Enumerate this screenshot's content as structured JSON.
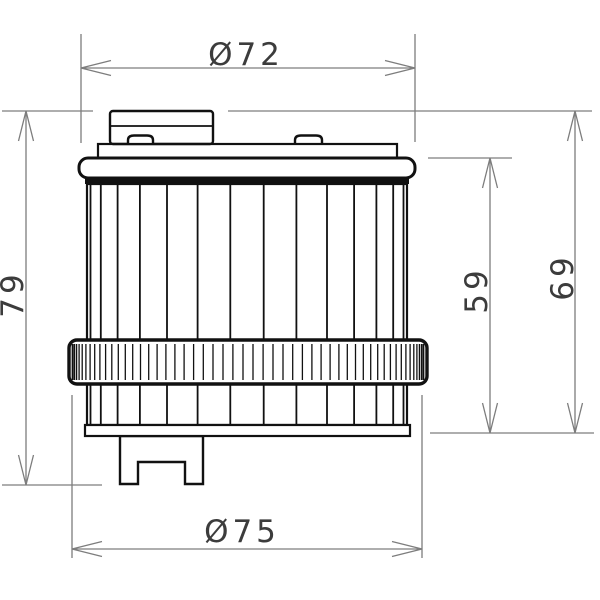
{
  "page": {
    "background": "#ffffff"
  },
  "drawing": {
    "labels": {
      "dia_top": "Ø72",
      "dia_bottom": "Ø75",
      "height_overall": "79",
      "height_element": "59",
      "height_body": "69"
    },
    "colors": {
      "outline": "#111111",
      "dimension": "#7d7d7d",
      "text": "#3c3c3c",
      "background": "#ffffff"
    }
  }
}
